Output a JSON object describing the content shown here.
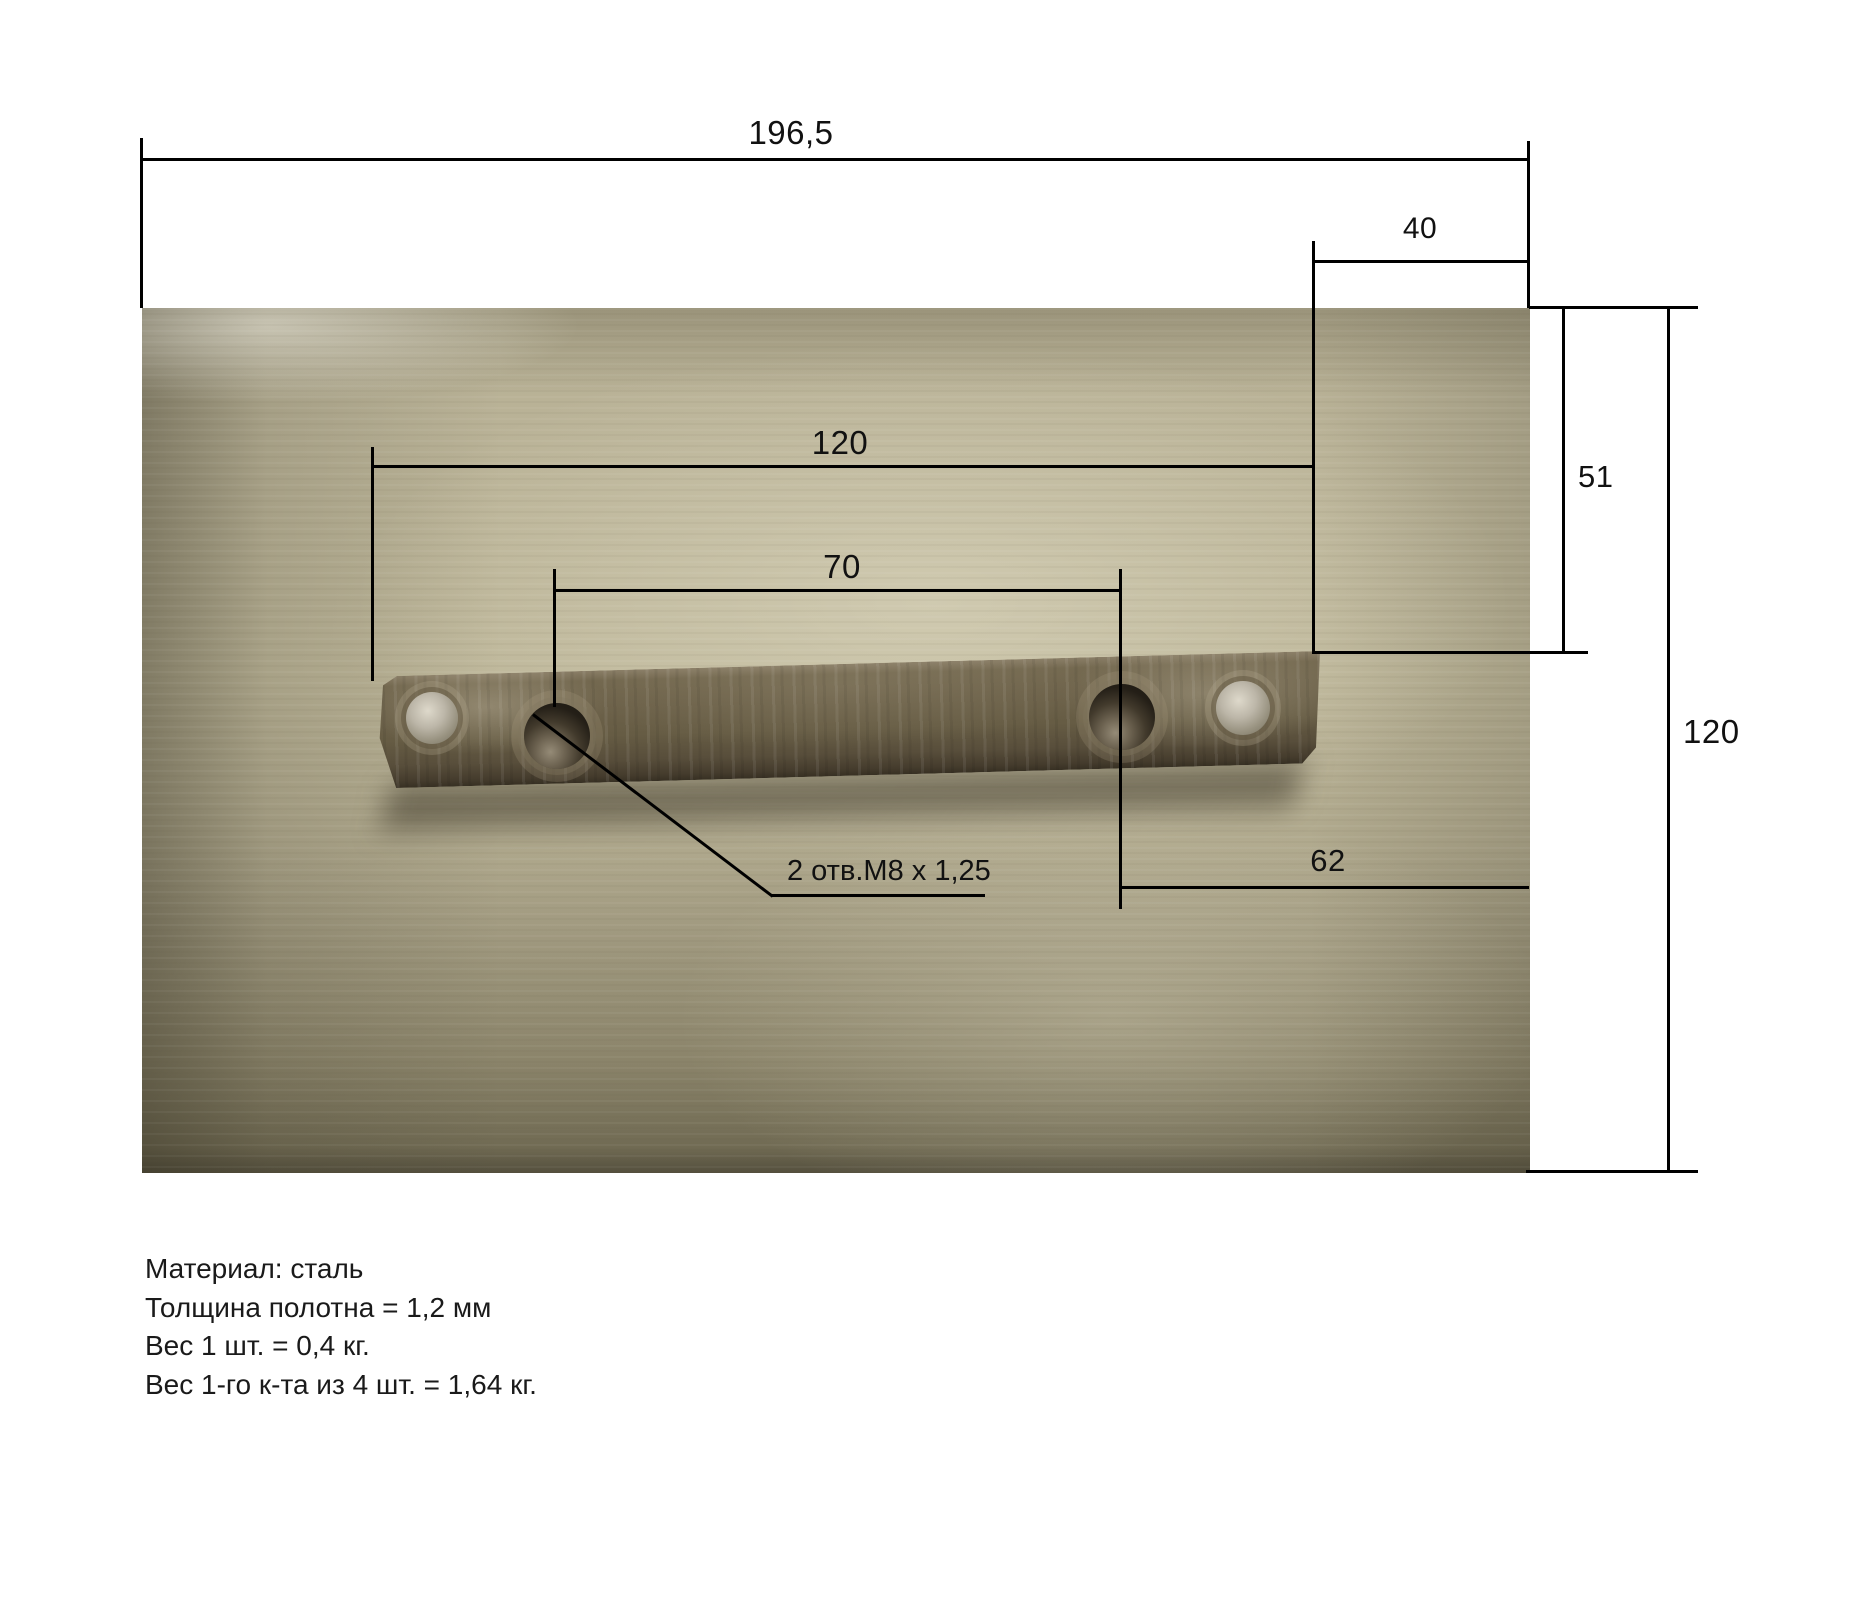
{
  "dimensions": {
    "overall_width": "196,5",
    "right_offset": "40",
    "bar_length": "120",
    "hole_spacing": "70",
    "hole_to_edge": "62",
    "top_right_offset": "51",
    "overall_height": "120"
  },
  "leader_note": "2 отв.М8 х 1,25",
  "notes": {
    "lines": [
      "Материал: сталь",
      "Толщина полотна = 1,2 мм",
      "Вес 1 шт. = 0,4 кг.",
      "Вес 1-го к-та из 4 шт. = 1,64 кг."
    ]
  },
  "colors": {
    "background": "#ffffff",
    "line": "#000000",
    "text": "#1a1a1a",
    "photo_base": "#b2ab90",
    "bar": "#665c47"
  }
}
